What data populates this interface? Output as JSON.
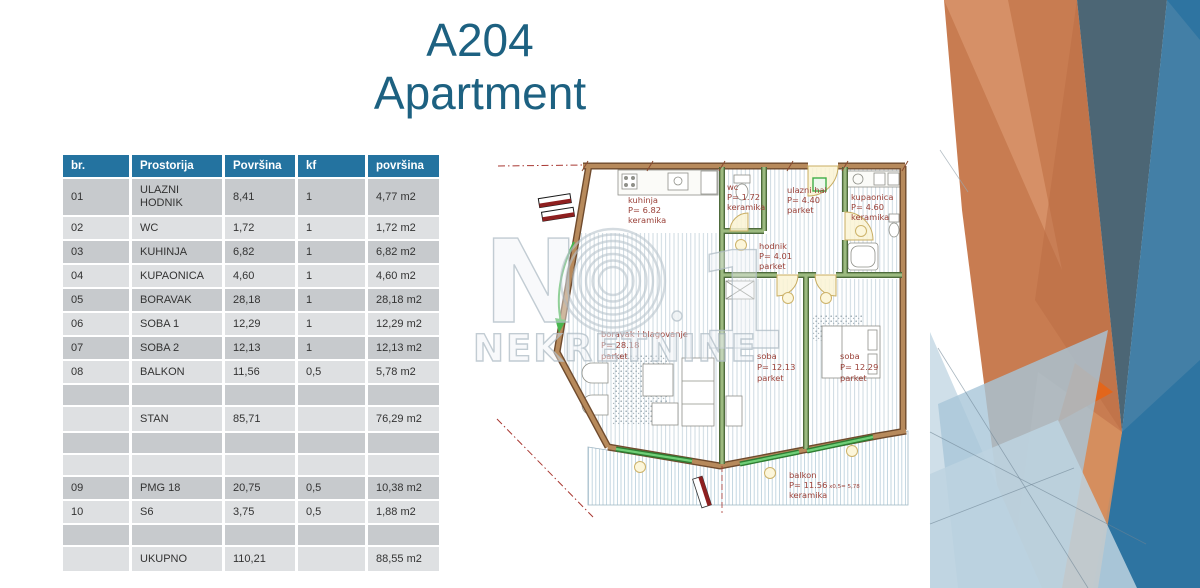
{
  "title": {
    "line1": "A204",
    "line2": "Apartment"
  },
  "colors": {
    "title-color": "#1d6181",
    "header-bg": "#2473a0",
    "row-dark": "#c7cacd",
    "row-light": "#dee0e2",
    "cell-text": "#333333",
    "accent-orange": "#c87c51",
    "accent-blue": "#2e74a1",
    "plan-label-red": "#9a4038",
    "plan-window-green": "#3fae47"
  },
  "table": {
    "headers": [
      "br.",
      "Prostorija",
      "Površina",
      "kf",
      "površina"
    ],
    "rows": [
      {
        "cells": [
          "01",
          "ULAZNI HODNIK",
          "8,41",
          "1",
          "4,77 m2"
        ],
        "shade": "dark",
        "kind": "tall"
      },
      {
        "cells": [
          "02",
          "WC",
          "1,72",
          "1",
          "1,72 m2"
        ],
        "shade": "light",
        "kind": "row"
      },
      {
        "cells": [
          "03",
          "KUHINJA",
          "6,82",
          "1",
          "6,82 m2"
        ],
        "shade": "dark",
        "kind": "row"
      },
      {
        "cells": [
          "04",
          "KUPAONICA",
          "4,60",
          "1",
          "4,60 m2"
        ],
        "shade": "light",
        "kind": "row"
      },
      {
        "cells": [
          "05",
          "BORAVAK",
          "28,18",
          "1",
          "28,18 m2"
        ],
        "shade": "dark",
        "kind": "row"
      },
      {
        "cells": [
          "06",
          "SOBA 1",
          "12,29",
          "1",
          "12,29 m2"
        ],
        "shade": "light",
        "kind": "row"
      },
      {
        "cells": [
          "07",
          "SOBA 2",
          "12,13",
          "1",
          "12,13 m2"
        ],
        "shade": "dark",
        "kind": "row"
      },
      {
        "cells": [
          "08",
          "BALKON",
          "11,56",
          "0,5",
          "5,78 m2"
        ],
        "shade": "light",
        "kind": "row"
      },
      {
        "cells": [
          "",
          "",
          "",
          "",
          ""
        ],
        "shade": "dark",
        "kind": "empty"
      },
      {
        "cells": [
          "",
          "STAN",
          "85,71",
          "",
          "76,29 m2"
        ],
        "shade": "light",
        "kind": "sum"
      },
      {
        "cells": [
          "",
          "",
          "",
          "",
          ""
        ],
        "shade": "dark",
        "kind": "empty"
      },
      {
        "cells": [
          "",
          "",
          "",
          "",
          ""
        ],
        "shade": "light",
        "kind": "empty"
      },
      {
        "cells": [
          "09",
          "PMG 18",
          "20,75",
          "0,5",
          "10,38 m2"
        ],
        "shade": "dark",
        "kind": "row"
      },
      {
        "cells": [
          "10",
          "S6",
          "3,75",
          "0,5",
          "1,88 m2"
        ],
        "shade": "light",
        "kind": "row"
      },
      {
        "cells": [
          "",
          "",
          "",
          "",
          ""
        ],
        "shade": "dark",
        "kind": "empty"
      },
      {
        "cells": [
          "",
          "UKUPNO",
          "110,21",
          "",
          "88,55 m2"
        ],
        "shade": "light",
        "kind": "sum"
      }
    ]
  },
  "floor_plan": {
    "rooms": [
      {
        "id": "kuhinja",
        "lines": [
          "kuhinja",
          "P= 6.82",
          "keramika"
        ]
      },
      {
        "id": "wc",
        "lines": [
          "wc",
          "P= 1.72",
          "keramika"
        ]
      },
      {
        "id": "ulazni-hal",
        "lines": [
          "ulazni hal",
          "P= 4.40",
          "parket"
        ]
      },
      {
        "id": "kupaonica",
        "lines": [
          "kupaonica",
          "P= 4.60",
          "keramika"
        ]
      },
      {
        "id": "hodnik",
        "lines": [
          "hodnik",
          "P= 4.01",
          "parket"
        ]
      },
      {
        "id": "boravak",
        "lines": [
          "boravak i blagovanje",
          "P= 28.18",
          "parket"
        ]
      },
      {
        "id": "soba-1",
        "lines": [
          "soba",
          "P= 12.13",
          "parket"
        ]
      },
      {
        "id": "soba-2",
        "lines": [
          "soba",
          "P= 12.29",
          "parket"
        ]
      },
      {
        "id": "balkon",
        "lines": [
          "balkon",
          "P= 11.56",
          "keramika"
        ],
        "extra": " x0,5= 5,78"
      }
    ],
    "watermark": {
      "letter": "N",
      "digit": "1",
      "label": "NEKRETNINE"
    }
  }
}
